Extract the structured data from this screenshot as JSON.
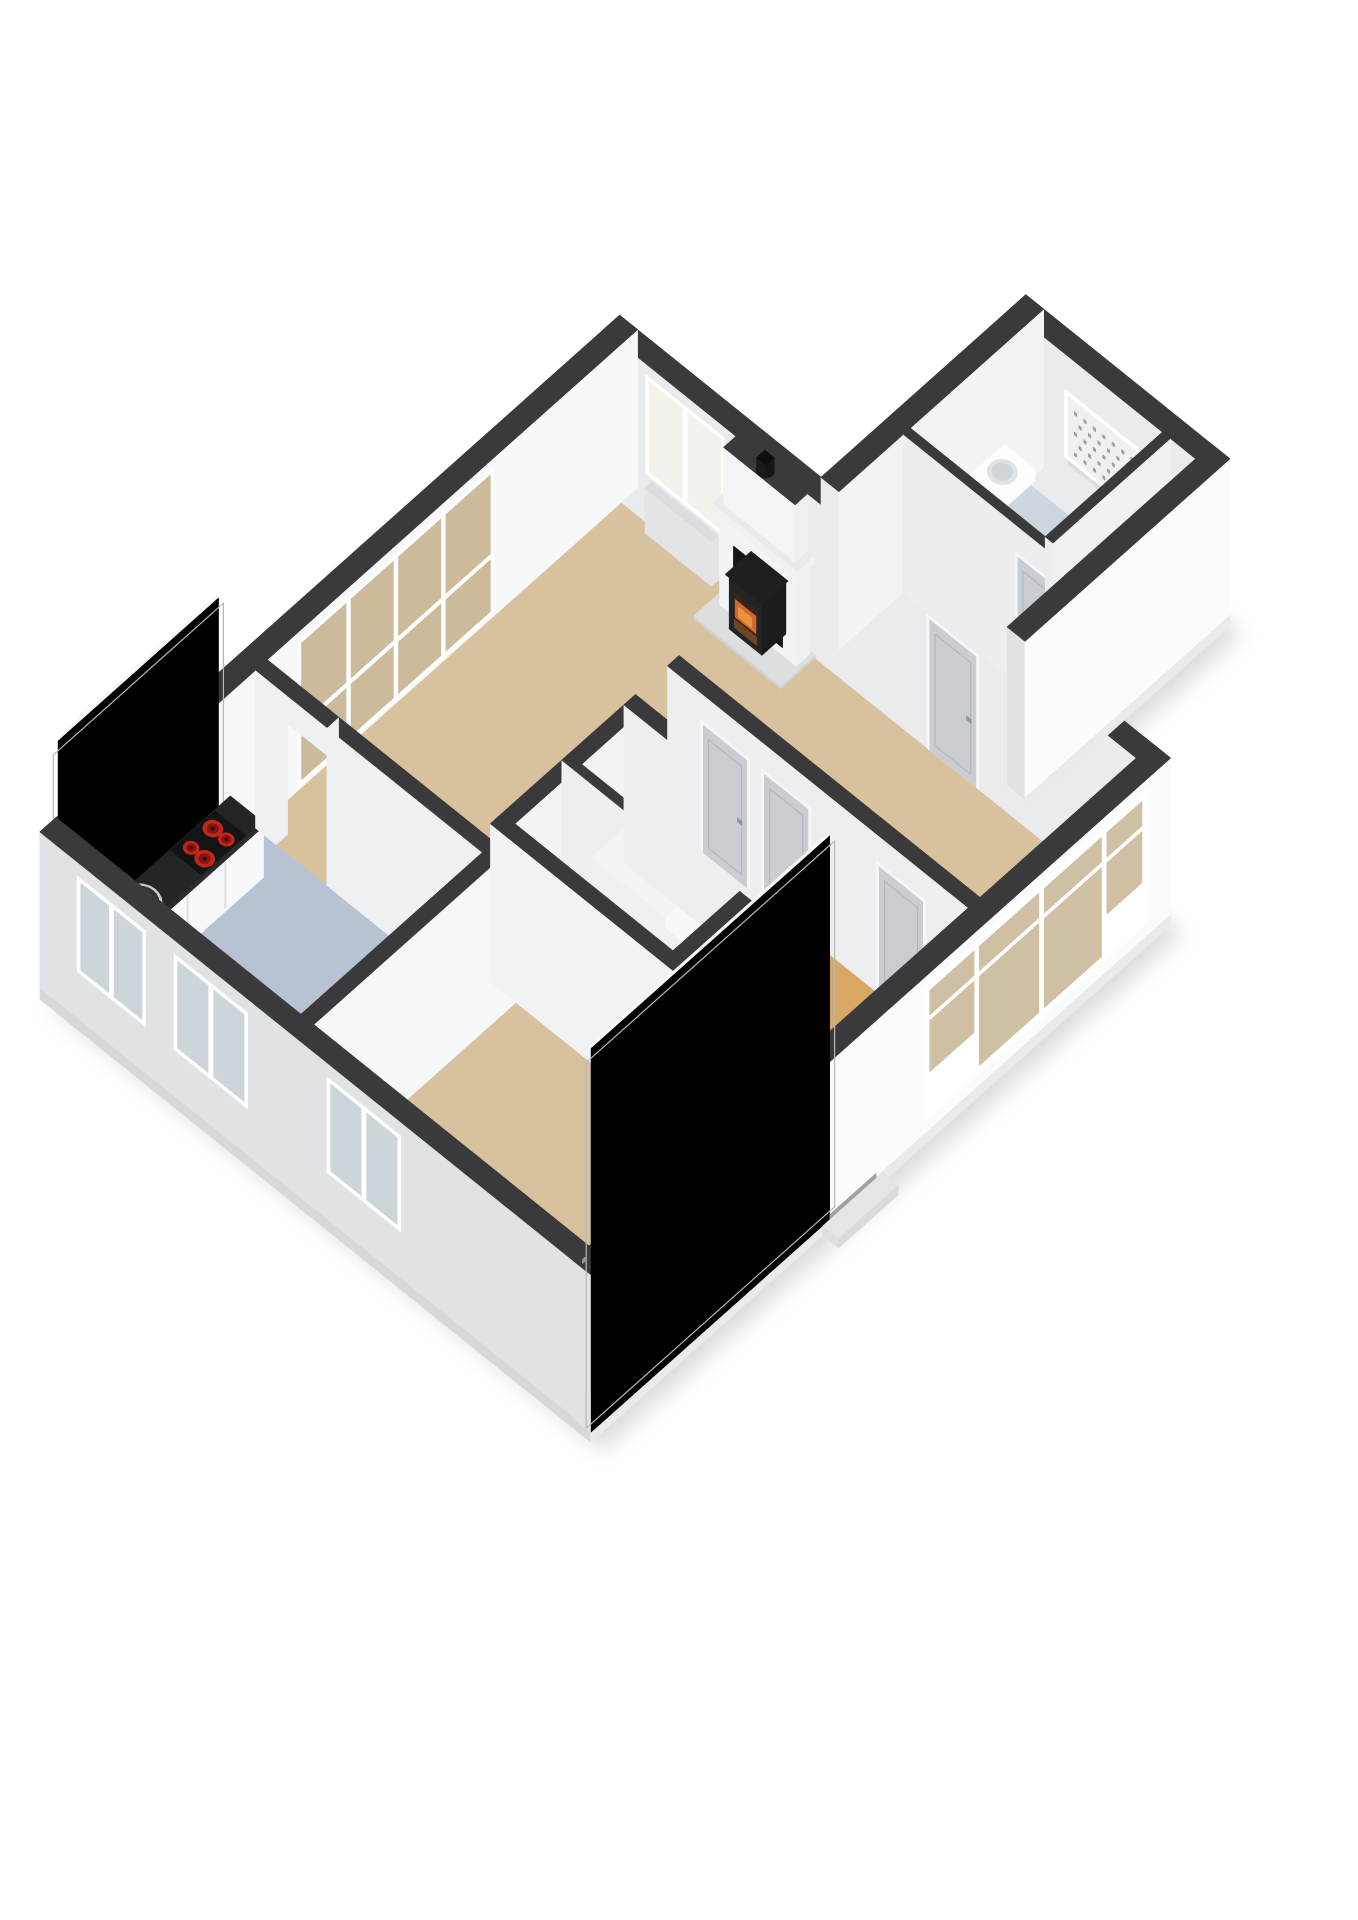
{
  "scene": {
    "background": "#ffffff",
    "shadow": "#9aa0a5",
    "type": "3d-isometric-floorplan"
  },
  "palette": {
    "wallTop": "#3a3a3c",
    "wallInteriorFront": "#f7f8f9",
    "wallInteriorSide": "#e9ebec",
    "partitionWest": "#ededef",
    "partitionSouth": "#f4f5f6",
    "exteriorWest": "#e0e3e5",
    "exteriorSouth": "#fafbfc",
    "plinth": "#e8eaec",
    "slab": "#ebedee",
    "floorLiving": "#d8c29e",
    "floorKitchen": "#b7c3d2",
    "floorHall": "#d8a763",
    "floorToilet": "#cbd6e1",
    "floorUtility": "#eff0f1",
    "glassTan": "#cbbb9b",
    "glassWarm": "#cfc0a3",
    "glassCool": "#ccd5da",
    "glassBright": "#f3f1ec",
    "glassMuted": "#d6cfc2",
    "glassFrosted": "#eef0f1",
    "frostDot": "#9aa1a7",
    "frameWhite": "#ffffff",
    "doorLeaf": "#c9ccd0",
    "doorLeafLight": "#e3e5e7",
    "doorFrame": "#f5f6f7",
    "doorPanelLine": "#b4b8bc",
    "handle": "#8f969c",
    "counterTop": "#232527",
    "counterEdge": "#2a2c2e",
    "cabinet": "#f7f8f9",
    "cabinetSeam": "#dcdee0",
    "cooktop": "#131416",
    "burnerRing": "#c2271a",
    "burnerCore": "#821711",
    "burnerDot": "#3c0d08",
    "sinkRim": "#c7cbce",
    "sinkBowl": "#313335",
    "sinkShade": "#232527",
    "drain": "#0f1011",
    "faucet": "#c3c8cc",
    "stoveDark": "#1b1c1e",
    "stoveFace": "#232426",
    "fireBack": "#3a241a",
    "fireGlow": "#cf6a2e",
    "fireCore": "#e8913f",
    "log": "#6e4526",
    "hearthTop": "#dcdedf",
    "hearthSide": "#d0d3d5",
    "mantel": "#eff1f2",
    "chimneyWest": "#f3f4f5",
    "chimneySouth": "#eef0f1",
    "flue": "#141416",
    "threshold": "#c07a3e",
    "stepWest": "#eef0f2",
    "stepSouth": "#fbfcfd",
    "stepTop": "#f6f8f9",
    "basin": "#fbfcfd",
    "basinShade": "#dfe3e6",
    "basinInner": "#ced4d8",
    "sillGray": "#dadcdf",
    "radiator": "#e2e4e6"
  },
  "rooms": [
    {
      "id": "living-room",
      "floor": "floorLiving"
    },
    {
      "id": "kitchen",
      "floor": "floorKitchen"
    },
    {
      "id": "bedroom",
      "floor": "floorLiving"
    },
    {
      "id": "hall",
      "floor": "floorHall"
    },
    {
      "id": "corridor",
      "floor": "floorHall"
    },
    {
      "id": "closet-a",
      "floor": "floorUtility"
    },
    {
      "id": "closet-b",
      "floor": "floorUtility"
    },
    {
      "id": "stair-well",
      "floor": "floorUtility"
    },
    {
      "id": "annex-hall",
      "floor": "floorUtility"
    },
    {
      "id": "toilet",
      "floor": "floorToilet"
    },
    {
      "id": "storage-pocket",
      "floor": "floorUtility"
    }
  ],
  "features": [
    "kitchen-counter-with-sink",
    "cooktop-four-burners",
    "kitchen-wall-counter",
    "wood-stove-fireplace",
    "chimney-with-flue",
    "staircase",
    "washbasin",
    "frosted-window",
    "window-band",
    "sliding-glazing",
    "front-door",
    "interior-doors",
    "door-threshold"
  ]
}
